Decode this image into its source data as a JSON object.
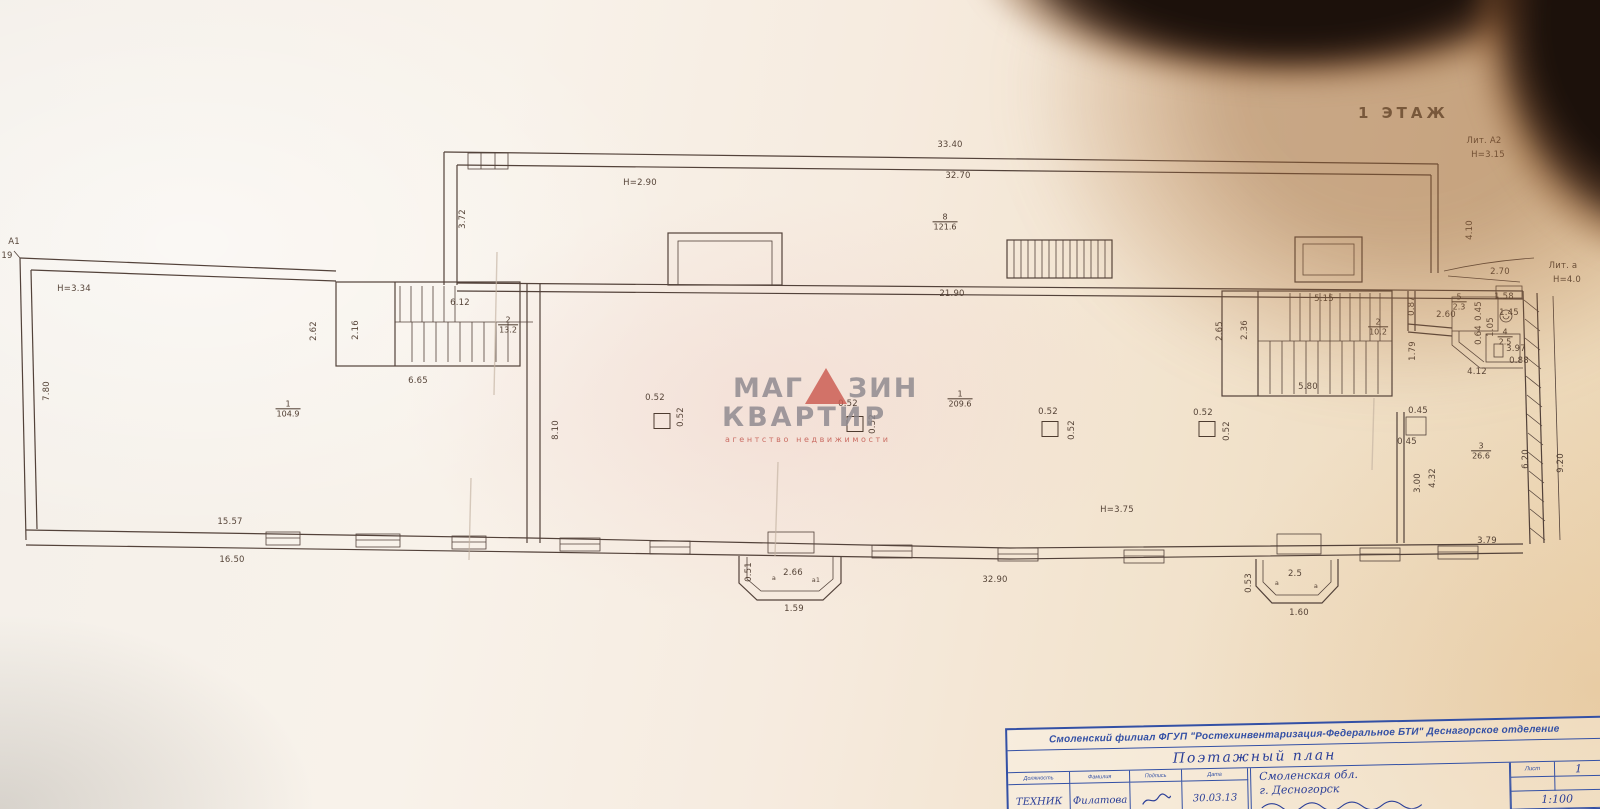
{
  "colors": {
    "watermark_red": "#cb5a50",
    "ink_blue": "#3350a5",
    "plan_ink": "#53423a"
  },
  "plan": {
    "floor_label": "1 ЭТАЖ",
    "annotations": [
      {
        "text": "33.40",
        "x": 950,
        "y": 145
      },
      {
        "text": "32.70",
        "x": 958,
        "y": 176
      },
      {
        "text": "Н=2.90",
        "x": 640,
        "y": 183
      },
      {
        "text": "3.72",
        "x": 463,
        "y": 219,
        "rot": -90
      },
      {
        "text": "4.10",
        "x": 1470,
        "y": 230,
        "rot": -90
      },
      {
        "text": "2.70",
        "x": 1500,
        "y": 272
      },
      {
        "text": "Лит. А2",
        "x": 1484,
        "y": 141
      },
      {
        "text": "Н=3.15",
        "x": 1488,
        "y": 155
      },
      {
        "text": "Лит. а",
        "x": 1563,
        "y": 266
      },
      {
        "text": "Н=4.0",
        "x": 1567,
        "y": 280
      },
      {
        "text": "А1",
        "x": 14,
        "y": 242
      },
      {
        "text": "19",
        "x": 7,
        "y": 256
      },
      {
        "text": "Н=3.34",
        "x": 74,
        "y": 289
      },
      {
        "text": "7.80",
        "x": 47,
        "y": 391,
        "rot": -90
      },
      {
        "text": "21.90",
        "x": 952,
        "y": 294
      },
      {
        "text": "6.12",
        "x": 460,
        "y": 303
      },
      {
        "text": "2.62",
        "x": 314,
        "y": 331,
        "rot": -90
      },
      {
        "text": "2.16",
        "x": 356,
        "y": 330,
        "rot": -90
      },
      {
        "text": "6.65",
        "x": 418,
        "y": 381
      },
      {
        "text": "8.10",
        "x": 556,
        "y": 430,
        "rot": -90
      },
      {
        "text": "Н=3.75",
        "x": 1117,
        "y": 510
      },
      {
        "text": "0.52",
        "x": 655,
        "y": 398
      },
      {
        "text": "0.52",
        "x": 681,
        "y": 417,
        "rot": -90
      },
      {
        "text": "0.52",
        "x": 848,
        "y": 404
      },
      {
        "text": "0.52",
        "x": 873,
        "y": 424,
        "rot": -90
      },
      {
        "text": "0.52",
        "x": 1048,
        "y": 412
      },
      {
        "text": "0.52",
        "x": 1072,
        "y": 430,
        "rot": -90
      },
      {
        "text": "0.52",
        "x": 1203,
        "y": 413
      },
      {
        "text": "0.52",
        "x": 1227,
        "y": 431,
        "rot": -90
      },
      {
        "text": "5.15",
        "x": 1324,
        "y": 299
      },
      {
        "text": "2.65",
        "x": 1220,
        "y": 331,
        "rot": -90
      },
      {
        "text": "2.36",
        "x": 1245,
        "y": 330,
        "rot": -90
      },
      {
        "text": "5.80",
        "x": 1308,
        "y": 387
      },
      {
        "text": "0.87",
        "x": 1412,
        "y": 306,
        "rot": -90
      },
      {
        "text": "2.60",
        "x": 1446,
        "y": 315
      },
      {
        "text": "0.45",
        "x": 1479,
        "y": 311,
        "rot": -90
      },
      {
        "text": "1.58",
        "x": 1504,
        "y": 297
      },
      {
        "text": "1.45",
        "x": 1509,
        "y": 313
      },
      {
        "text": "1.05",
        "x": 1491,
        "y": 327,
        "rot": -90
      },
      {
        "text": "0.64",
        "x": 1479,
        "y": 335,
        "rot": -90
      },
      {
        "text": "3.97",
        "x": 1516,
        "y": 349
      },
      {
        "text": "0.88",
        "x": 1519,
        "y": 361
      },
      {
        "text": "4.12",
        "x": 1477,
        "y": 372
      },
      {
        "text": "1.79",
        "x": 1413,
        "y": 351,
        "rot": -90
      },
      {
        "text": "0.45",
        "x": 1418,
        "y": 411
      },
      {
        "text": "0.45",
        "x": 1407,
        "y": 442
      },
      {
        "text": "6.20",
        "x": 1526,
        "y": 459,
        "rot": -90
      },
      {
        "text": "9.20",
        "x": 1561,
        "y": 463,
        "rot": -90
      },
      {
        "text": "3.00",
        "x": 1418,
        "y": 483,
        "rot": -90
      },
      {
        "text": "4.32",
        "x": 1433,
        "y": 478,
        "rot": -90
      },
      {
        "text": "3.79",
        "x": 1487,
        "y": 541
      },
      {
        "text": "15.57",
        "x": 230,
        "y": 522
      },
      {
        "text": "16.50",
        "x": 232,
        "y": 560
      },
      {
        "text": "32.90",
        "x": 995,
        "y": 580
      },
      {
        "text": "0.51",
        "x": 749,
        "y": 572,
        "rot": -90
      },
      {
        "text": "2.66",
        "x": 793,
        "y": 573
      },
      {
        "text": "а",
        "x": 774,
        "y": 578,
        "cls": "tiny"
      },
      {
        "text": "а1",
        "x": 816,
        "y": 580,
        "cls": "tiny"
      },
      {
        "text": "1.59",
        "x": 794,
        "y": 609
      },
      {
        "text": "0.53",
        "x": 1249,
        "y": 583,
        "rot": -90
      },
      {
        "text": "2.5",
        "x": 1295,
        "y": 574
      },
      {
        "text": "а",
        "x": 1277,
        "y": 583,
        "cls": "tiny"
      },
      {
        "text": "а",
        "x": 1316,
        "y": 586,
        "cls": "tiny"
      },
      {
        "text": "1.60",
        "x": 1299,
        "y": 613
      }
    ],
    "rooms": [
      {
        "num": "1",
        "area": "104.9",
        "x": 288,
        "y": 409
      },
      {
        "num": "2",
        "area": "13.2",
        "x": 508,
        "y": 325
      },
      {
        "num": "8",
        "area": "121.6",
        "x": 945,
        "y": 222
      },
      {
        "num": "1",
        "area": "209.6",
        "x": 960,
        "y": 399
      },
      {
        "num": "2",
        "area": "10.2",
        "x": 1378,
        "y": 327
      },
      {
        "num": "5",
        "area": "2.3",
        "x": 1459,
        "y": 302
      },
      {
        "num": "4",
        "area": "2.5",
        "x": 1505,
        "y": 337
      },
      {
        "num": "3",
        "area": "26.6",
        "x": 1481,
        "y": 451
      }
    ],
    "columns": [
      {
        "x": 662,
        "y": 421
      },
      {
        "x": 855,
        "y": 424
      },
      {
        "x": 1050,
        "y": 429
      },
      {
        "x": 1207,
        "y": 429
      }
    ]
  },
  "watermark": {
    "word1_part1": "МАГ",
    "word1_part2": "ЗИН",
    "word2": "КВАРТИР",
    "caption": "агентство недвижимости"
  },
  "title_block": {
    "org": "Смоленский филиал ФГУП \"Ростехинвентаризация-Федеральное БТИ\" Деснагорское отделение",
    "doc_title": "Поэтажный план",
    "col_headers": [
      "Должность",
      "Фамилия",
      "Подпись",
      "Дата"
    ],
    "row": {
      "position": "ТЕХНИК",
      "name": "Филатова",
      "date": "30.03.13"
    },
    "location": [
      "Смоленская обл.",
      "г. Десногорск"
    ],
    "sheet_label": "Лист",
    "sheet_value": "1",
    "scale_value": "1:100"
  }
}
